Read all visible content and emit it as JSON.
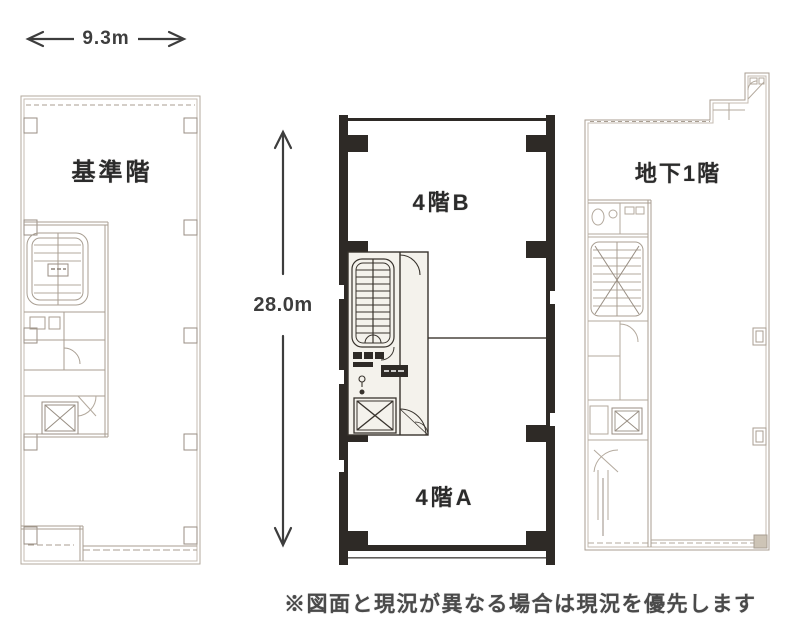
{
  "document": {
    "type_label": "floor-plan-sheet",
    "note": "※図面と現況が異なる場合は現況を優先します"
  },
  "dimensions": {
    "width": {
      "label": "9.3m"
    },
    "height": {
      "label": "28.0m"
    }
  },
  "plans": {
    "standard_floor": {
      "label": "基準階"
    },
    "fourth_floor_b": {
      "label": "4階B"
    },
    "fourth_floor_a": {
      "label": "4階A"
    },
    "basement_first": {
      "label": "地下1階"
    }
  },
  "colors": {
    "background": "#ffffff",
    "bold_wall": "#2e2a26",
    "light_line": "#b3a99d",
    "light_line_dark": "#988e83",
    "label_text": "#2b2b2b",
    "note_text": "#4a4a4a",
    "dimension_text": "#3d3d3d",
    "corner_fill": "#cdc4b6"
  }
}
